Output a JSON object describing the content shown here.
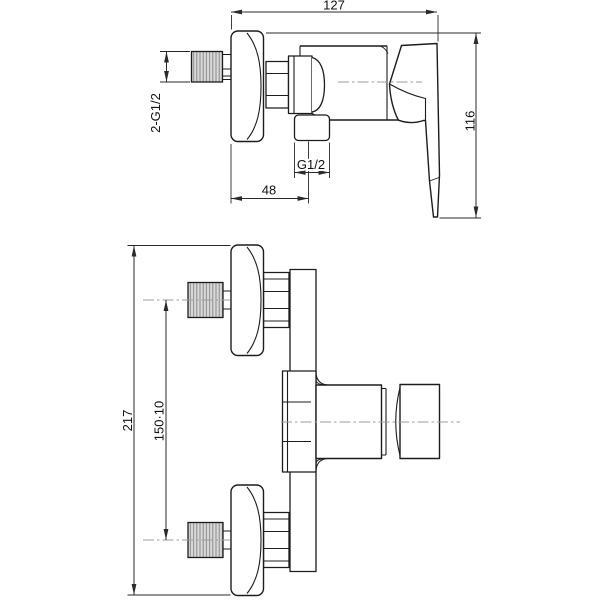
{
  "drawing": {
    "colors": {
      "background": "#ffffff",
      "line": "#1c1c1c",
      "dimension": "#2a2a2a",
      "centerline": "#9c9c9c",
      "hatch_fill": "#d9d9d9",
      "hatch_stroke": "#8a8a8a",
      "text": "#111111"
    },
    "side_view": {
      "labels": {
        "overall_width": "127",
        "overall_height": "116",
        "inlet_threads": "2-G1/2",
        "outlet_thread": "G1/2",
        "outlet_offset": "48"
      }
    },
    "front_view": {
      "labels": {
        "overall_height": "217",
        "connection_spacing": "150·10"
      }
    }
  }
}
